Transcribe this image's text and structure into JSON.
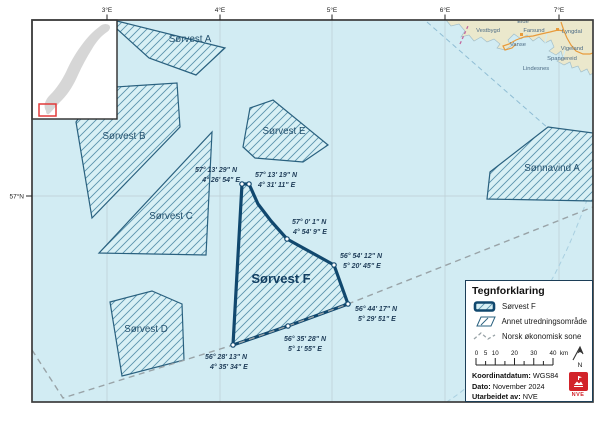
{
  "map": {
    "axis": {
      "top": [
        "3°E",
        "4°E",
        "5°E",
        "6°E",
        "7°E"
      ],
      "left": [
        "57°N"
      ]
    },
    "areas": {
      "a": {
        "label": "Sørvest A"
      },
      "b": {
        "label": "Sørvest B"
      },
      "c": {
        "label": "Sørvest C"
      },
      "d": {
        "label": "Sørvest D"
      },
      "e": {
        "label": "Sørvest E"
      },
      "f": {
        "label": "Sørvest F"
      },
      "sonnavind": {
        "label": "Sønnavind A"
      }
    },
    "coords": [
      {
        "lat": "57° 13' 29\" N",
        "lon": "4° 26' 54\" E"
      },
      {
        "lat": "57° 13' 19\" N",
        "lon": "4° 31' 11\" E"
      },
      {
        "lat": "57° 0' 1\" N",
        "lon": "4° 54' 9\" E"
      },
      {
        "lat": "56° 54' 12\" N",
        "lon": "5° 20' 45\" E"
      },
      {
        "lat": "56° 44' 17\" N",
        "lon": "5° 29' 51\" E"
      },
      {
        "lat": "56° 35' 28\" N",
        "lon": "5° 1' 55\" E"
      },
      {
        "lat": "56° 28' 13\" N",
        "lon": "4° 35' 34\" E"
      }
    ],
    "places": [
      "Eide",
      "Vestbygd",
      "Farsund",
      "Vanse",
      "Lyngdal",
      "Vigeland",
      "Spangereid",
      "Lindesnes"
    ]
  },
  "legend": {
    "title": "Tegnforklaring",
    "items": [
      {
        "label": "Sørvest F"
      },
      {
        "label": "Annet utredningsområde"
      },
      {
        "label": "Norsk økonomisk sone"
      }
    ],
    "scale": {
      "labels": [
        "0",
        "5",
        "10",
        "20",
        "30",
        "40"
      ],
      "unit": "km"
    },
    "north_label": "N",
    "meta": [
      {
        "label": "Koordinatdatum:",
        "value": "WGS84"
      },
      {
        "label": "Dato:",
        "value": "November 2024"
      },
      {
        "label": "Utarbeidet av:",
        "value": "NVE"
      }
    ],
    "logo": "NVE"
  },
  "colors": {
    "sea": "#d2ecf3",
    "hatch_fill": "#d8f0f5",
    "hatch_line": "#5a93ad",
    "area_border": "#2a617f",
    "f_border": "#11486e",
    "econ_line": "#99a3a7",
    "land": "#ebe8cc",
    "road": "#e89b3c",
    "nve_red": "#d2232a"
  }
}
